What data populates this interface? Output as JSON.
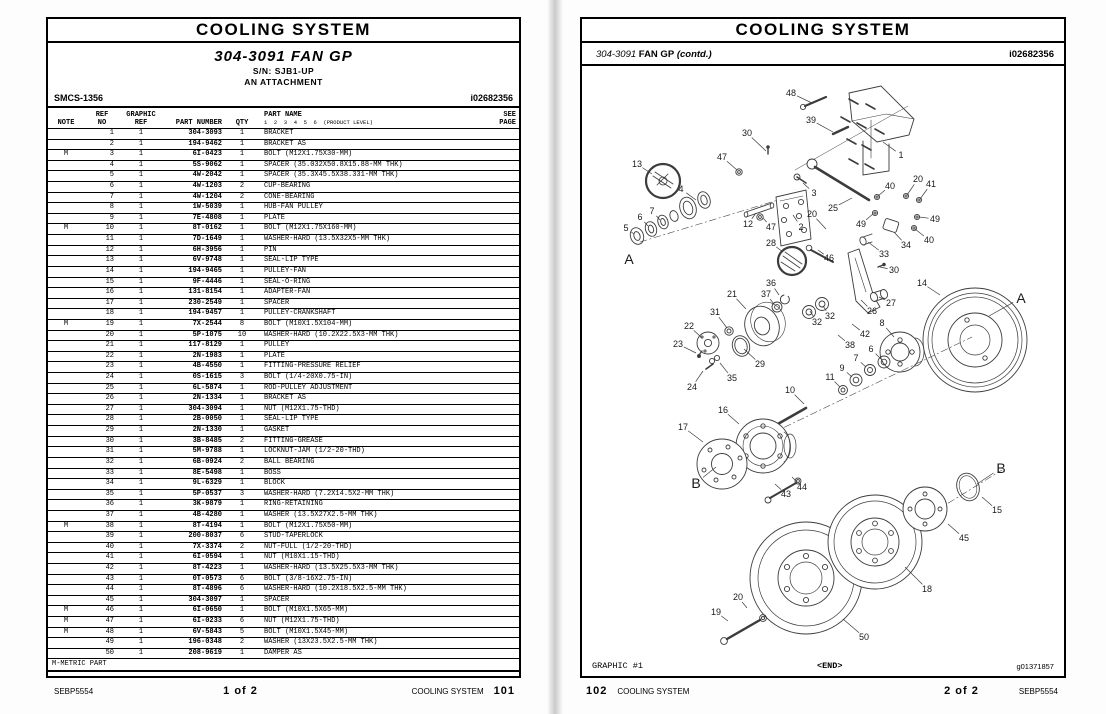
{
  "page_left": {
    "title": "COOLING SYSTEM",
    "subtitle": "304-3091 FAN GP",
    "serial": "S/N: SJB1-UP",
    "attachment": "AN ATTACHMENT",
    "smcs": "SMCS-1356",
    "doc_id": "i02682356",
    "table": {
      "headers": {
        "note": "NOTE",
        "ref": "REF\nNO",
        "graphic": "GRAPHIC\nREF",
        "part_number": "PART NUMBER",
        "qty": "QTY",
        "part_name": "PART NAME",
        "product_level": "1  2  3  4  5  6  (PRODUCT LEVEL)",
        "see_page": "SEE\nPAGE"
      },
      "rows": [
        [
          "",
          "1",
          "1",
          "304-3093",
          "1",
          "BRACKET"
        ],
        [
          "",
          "2",
          "1",
          "194-9462",
          "1",
          "BRACKET AS"
        ],
        [
          "M",
          "3",
          "1",
          "6I-0423",
          "1",
          "BOLT (M12X1.75X30-MM)"
        ],
        [
          "",
          "4",
          "1",
          "5S-9062",
          "1",
          "SPACER (35.032X50.8X15.88-MM THK)"
        ],
        [
          "",
          "5",
          "1",
          "4W-2042",
          "1",
          "SPACER (35.3X45.5X38.331-MM THK)"
        ],
        [
          "",
          "6",
          "1",
          "4W-1203",
          "2",
          "CUP-BEARING"
        ],
        [
          "",
          "7",
          "1",
          "4W-1204",
          "2",
          "CONE-BEARING"
        ],
        [
          "",
          "8",
          "1",
          "1W-5039",
          "1",
          "HUB-FAN PULLEY"
        ],
        [
          "",
          "9",
          "1",
          "7E-4808",
          "1",
          "PLATE"
        ],
        [
          "M",
          "10",
          "1",
          "8T-0162",
          "1",
          "BOLT (M12X1.75X160-MM)"
        ],
        [
          "",
          "11",
          "1",
          "7D-1649",
          "1",
          "WASHER-HARD (13.5X32X5-MM THK)"
        ],
        [
          "",
          "12",
          "1",
          "6H-3956",
          "1",
          "PIN"
        ],
        [
          "",
          "13",
          "1",
          "6V-9748",
          "1",
          "SEAL-LIP TYPE"
        ],
        [
          "",
          "14",
          "1",
          "194-9465",
          "1",
          "PULLEY-FAN"
        ],
        [
          "",
          "15",
          "1",
          "9F-4446",
          "1",
          "SEAL-O-RING"
        ],
        [
          "",
          "16",
          "1",
          "131-8154",
          "1",
          "ADAPTER-FAN"
        ],
        [
          "",
          "17",
          "1",
          "230-2549",
          "1",
          "SPACER"
        ],
        [
          "",
          "18",
          "1",
          "194-9457",
          "1",
          "PULLEY-CRANKSHAFT"
        ],
        [
          "M",
          "19",
          "1",
          "7X-2544",
          "8",
          "BOLT (M10X1.5X104-MM)"
        ],
        [
          "",
          "20",
          "1",
          "5P-1075",
          "10",
          "WASHER-HARD (10.2X22.5X3-MM THK)"
        ],
        [
          "",
          "21",
          "1",
          "117-8129",
          "1",
          "PULLEY"
        ],
        [
          "",
          "22",
          "1",
          "2N-1983",
          "1",
          "PLATE"
        ],
        [
          "",
          "23",
          "1",
          "4B-4550",
          "1",
          "FITTING-PRESSURE RELIEF"
        ],
        [
          "",
          "24",
          "1",
          "0S-1615",
          "3",
          "BOLT (1/4-20X0.75-IN)"
        ],
        [
          "",
          "25",
          "1",
          "6L-5874",
          "1",
          "ROD-PULLEY ADJUSTMENT"
        ],
        [
          "",
          "26",
          "1",
          "2N-1334",
          "1",
          "BRACKET AS"
        ],
        [
          "",
          "27",
          "1",
          "304-3094",
          "1",
          "NUT (M12X1.75-THD)"
        ],
        [
          "",
          "28",
          "1",
          "2B-0050",
          "1",
          "SEAL-LIP TYPE"
        ],
        [
          "",
          "29",
          "1",
          "2N-1330",
          "1",
          "GASKET"
        ],
        [
          "",
          "30",
          "1",
          "3B-8485",
          "2",
          "FITTING-GREASE"
        ],
        [
          "",
          "31",
          "1",
          "5M-9788",
          "1",
          "LOCKNUT-JAM (1/2-20-THD)"
        ],
        [
          "",
          "32",
          "1",
          "6B-0924",
          "2",
          "BALL BEARING"
        ],
        [
          "",
          "33",
          "1",
          "8E-5498",
          "1",
          "BOSS"
        ],
        [
          "",
          "34",
          "1",
          "9L-6329",
          "1",
          "BLOCK"
        ],
        [
          "",
          "35",
          "1",
          "5P-0537",
          "3",
          "WASHER-HARD (7.2X14.5X2-MM THK)"
        ],
        [
          "",
          "36",
          "1",
          "3K-9879",
          "1",
          "RING-RETAINING"
        ],
        [
          "",
          "37",
          "1",
          "4B-4280",
          "1",
          "WASHER (13.5X27X2.5-MM THK)"
        ],
        [
          "M",
          "38",
          "1",
          "8T-4194",
          "1",
          "BOLT (M12X1.75X50-MM)"
        ],
        [
          "",
          "39",
          "1",
          "200-8037",
          "6",
          "STUD-TAPERLOCK"
        ],
        [
          "",
          "40",
          "1",
          "7X-3374",
          "2",
          "NUT-FULL (1/2-20-THD)"
        ],
        [
          "",
          "41",
          "1",
          "6I-0594",
          "1",
          "NUT (M10X1.15-THD)"
        ],
        [
          "",
          "42",
          "1",
          "8T-4223",
          "1",
          "WASHER-HARD (13.5X25.5X3-MM THK)"
        ],
        [
          "",
          "43",
          "1",
          "0T-0573",
          "6",
          "BOLT (3/8-16X2.75-IN)"
        ],
        [
          "",
          "44",
          "1",
          "8T-4896",
          "6",
          "WASHER-HARD (10.2X18.5X2.5-MM THK)"
        ],
        [
          "",
          "45",
          "1",
          "304-3097",
          "1",
          "SPACER"
        ],
        [
          "M",
          "46",
          "1",
          "6I-0650",
          "1",
          "BOLT (M10X1.5X65-MM)"
        ],
        [
          "M",
          "47",
          "1",
          "6I-0233",
          "6",
          "NUT (M12X1.75-THD)"
        ],
        [
          "M",
          "48",
          "1",
          "6V-5843",
          "5",
          "BOLT (M10X1.5X45-MM)"
        ],
        [
          "",
          "49",
          "1",
          "196-0348",
          "2",
          "WASHER (13X23.5X2.5-MM THK)"
        ],
        [
          "",
          "50",
          "1",
          "208-9619",
          "1",
          "DAMPER AS"
        ]
      ],
      "footnote": "M-METRIC PART"
    },
    "footer": {
      "media": "SEBP5554",
      "sheet": "1 of 2",
      "section": "COOLING SYSTEM",
      "page_no": "101"
    }
  },
  "page_right": {
    "title": "COOLING SYSTEM",
    "subtitle_num": "304-3091",
    "subtitle_name": "FAN GP",
    "contd": "(contd.)",
    "doc_id": "i02682356",
    "graphic_label": "GRAPHIC #1",
    "end_label": "<END>",
    "graphic_id": "g01371857",
    "footer": {
      "page_no": "102",
      "section": "COOLING SYSTEM",
      "sheet": "2 of 2",
      "media": "SEBP5554"
    },
    "callouts": [
      [
        "48",
        791,
        93,
        812,
        103
      ],
      [
        "39",
        811,
        120,
        833,
        132
      ],
      [
        "30",
        747,
        133,
        766,
        151
      ],
      [
        "47",
        722,
        157,
        737,
        170
      ],
      [
        "13",
        637,
        164,
        652,
        174
      ],
      [
        "4",
        681,
        189,
        696,
        200
      ],
      [
        "3",
        814,
        193,
        803,
        183
      ],
      [
        "25",
        833,
        208,
        852,
        198
      ],
      [
        "20",
        812,
        214,
        826,
        229
      ],
      [
        "12",
        748,
        224,
        756,
        213
      ],
      [
        "47",
        771,
        227,
        763,
        218
      ],
      [
        "2",
        801,
        227,
        793,
        215
      ],
      [
        "28",
        771,
        243,
        783,
        252
      ],
      [
        "46",
        829,
        258,
        818,
        250
      ],
      [
        "5",
        626,
        228,
        634,
        234
      ],
      [
        "6",
        640,
        217,
        648,
        226
      ],
      [
        "7",
        652,
        211,
        660,
        220
      ],
      [
        "1",
        901,
        155,
        883,
        142
      ],
      [
        "40",
        890,
        186,
        878,
        196
      ],
      [
        "20",
        918,
        179,
        907,
        195
      ],
      [
        "41",
        931,
        184,
        920,
        199
      ],
      [
        "49",
        861,
        224,
        873,
        214
      ],
      [
        "49",
        935,
        219,
        919,
        217
      ],
      [
        "40",
        929,
        240,
        915,
        229
      ],
      [
        "34",
        906,
        245,
        894,
        232
      ],
      [
        "33",
        884,
        254,
        868,
        242
      ],
      [
        "30",
        894,
        270,
        880,
        267
      ],
      [
        "14",
        922,
        283,
        940,
        295
      ],
      [
        "36",
        771,
        283,
        779,
        295
      ],
      [
        "37",
        766,
        294,
        774,
        304
      ],
      [
        "21",
        732,
        294,
        746,
        309
      ],
      [
        "31",
        715,
        312,
        727,
        328
      ],
      [
        "27",
        891,
        303,
        879,
        297
      ],
      [
        "26",
        872,
        311,
        861,
        300
      ],
      [
        "32",
        830,
        316,
        823,
        306
      ],
      [
        "32",
        817,
        322,
        810,
        311
      ],
      [
        "8",
        882,
        323,
        894,
        337
      ],
      [
        "42",
        865,
        334,
        852,
        324
      ],
      [
        "38",
        850,
        345,
        838,
        335
      ],
      [
        "29",
        760,
        364,
        744,
        349
      ],
      [
        "35",
        732,
        378,
        720,
        363
      ],
      [
        "22",
        689,
        326,
        702,
        338
      ],
      [
        "23",
        678,
        344,
        696,
        353
      ],
      [
        "24",
        692,
        387,
        703,
        371
      ],
      [
        "6",
        871,
        349,
        881,
        359
      ],
      [
        "7",
        856,
        358,
        866,
        367
      ],
      [
        "9",
        842,
        368,
        852,
        377
      ],
      [
        "11",
        830,
        377,
        840,
        387
      ],
      [
        "10",
        790,
        390,
        804,
        404
      ],
      [
        "16",
        723,
        410,
        739,
        424
      ],
      [
        "17",
        683,
        427,
        703,
        442
      ],
      [
        "43",
        786,
        494,
        775,
        484
      ],
      [
        "44",
        802,
        487,
        792,
        477
      ],
      [
        "15",
        997,
        510,
        982,
        497
      ],
      [
        "45",
        964,
        538,
        948,
        524
      ],
      [
        "18",
        927,
        589,
        905,
        567
      ],
      [
        "50",
        864,
        637,
        843,
        619
      ],
      [
        "19",
        716,
        612,
        728,
        621
      ],
      [
        "20",
        738,
        597,
        747,
        608
      ]
    ],
    "letters": [
      [
        "A",
        629,
        259,
        null,
        null
      ],
      [
        "A",
        1021,
        298,
        989,
        316
      ],
      [
        "B",
        696,
        483,
        716,
        467
      ],
      [
        "B",
        1001,
        468,
        977,
        484
      ]
    ]
  }
}
